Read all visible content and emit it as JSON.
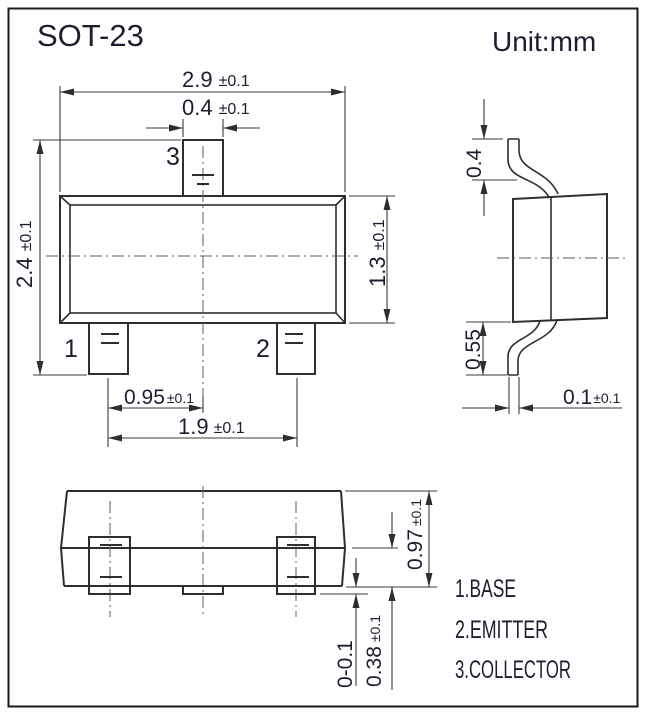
{
  "page": {
    "title": "SOT-23",
    "unit_label": "Unit:mm"
  },
  "front_view": {
    "pin_labels": {
      "pin1": "1",
      "pin2": "2",
      "pin3": "3"
    },
    "dimensions": {
      "body_width": {
        "value": "2.9",
        "tolerance": "±0.1"
      },
      "pin3_width": {
        "value": "0.4",
        "tolerance": "±0.1"
      },
      "overall_height": {
        "value": "2.4",
        "tolerance": "±0.1"
      },
      "body_height": {
        "value": "1.3",
        "tolerance": "±0.1"
      },
      "pin_pitch": {
        "value": "0.95",
        "tolerance": "±0.1"
      },
      "pin_span": {
        "value": "1.9",
        "tolerance": "±0.1"
      }
    }
  },
  "side_view": {
    "dimensions": {
      "upper_lead_height": {
        "value": "0.4"
      },
      "lower_lead_height": {
        "value": "0.55"
      },
      "lead_thickness": {
        "value": "0.1",
        "tolerance": "±0.1"
      }
    }
  },
  "bottom_view": {
    "dimensions": {
      "overall_height": {
        "value": "0.97",
        "tolerance": "±0.1"
      },
      "standoff": {
        "value": "0-0.1"
      },
      "lead_length": {
        "value": "0.38",
        "tolerance": "±0.1"
      }
    }
  },
  "legend": {
    "items": [
      {
        "label": "1.BASE"
      },
      {
        "label": "2.EMITTER"
      },
      {
        "label": "3.COLLECTOR"
      }
    ]
  },
  "colors": {
    "line": "#2e2e2e",
    "text": "#1d1d30",
    "background": "#ffffff",
    "border": "#1a1a1a"
  }
}
